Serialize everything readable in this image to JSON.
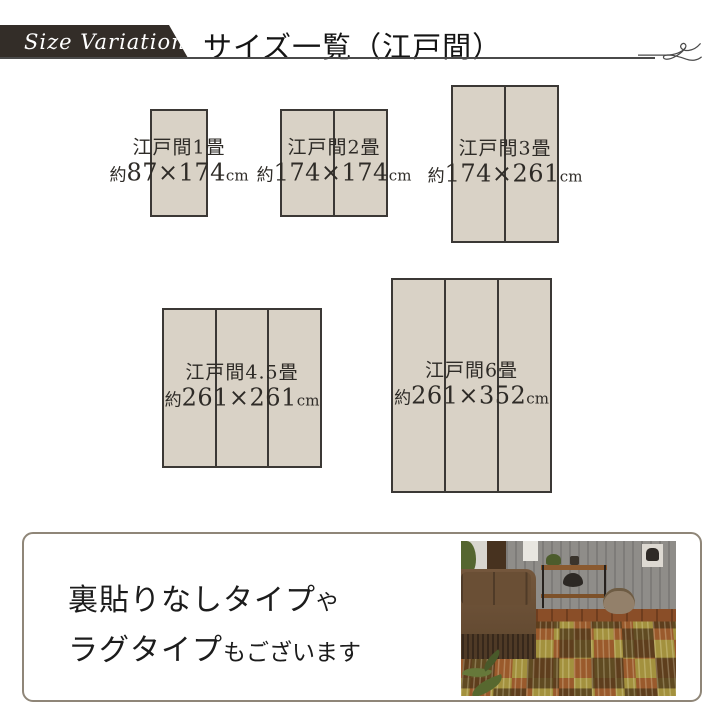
{
  "header": {
    "badge_label": "Size Variation",
    "title": "サイズ一覧（江戸間）"
  },
  "sizes": [
    {
      "name": "江戸間1畳",
      "approx_prefix": "約",
      "dimensions": "87×174",
      "unit": "cm",
      "panels": 1
    },
    {
      "name": "江戸間2畳",
      "approx_prefix": "約",
      "dimensions": "174×174",
      "unit": "cm",
      "panels": 2
    },
    {
      "name": "江戸間3畳",
      "approx_prefix": "約",
      "dimensions": "174×261",
      "unit": "cm",
      "panels": 2
    },
    {
      "name": "江戸間4.5畳",
      "approx_prefix": "約",
      "dimensions": "261×261",
      "unit": "cm",
      "panels": 3
    },
    {
      "name": "江戸間6畳",
      "approx_prefix": "約",
      "dimensions": "261×352",
      "unit": "cm",
      "panels": 3
    }
  ],
  "footer": {
    "line1_main": "裏貼りなしタイプ",
    "line1_small": "や",
    "line2_main": "ラグタイプ",
    "line2_small": "もございます"
  },
  "colors": {
    "ribbon_bg": "#332d28",
    "tatami_fill": "#d9d2c6",
    "tatami_border": "#3b3835",
    "rule": "#4a4a4a",
    "footer_border": "#8f8678",
    "text": "#2b2b2b"
  }
}
